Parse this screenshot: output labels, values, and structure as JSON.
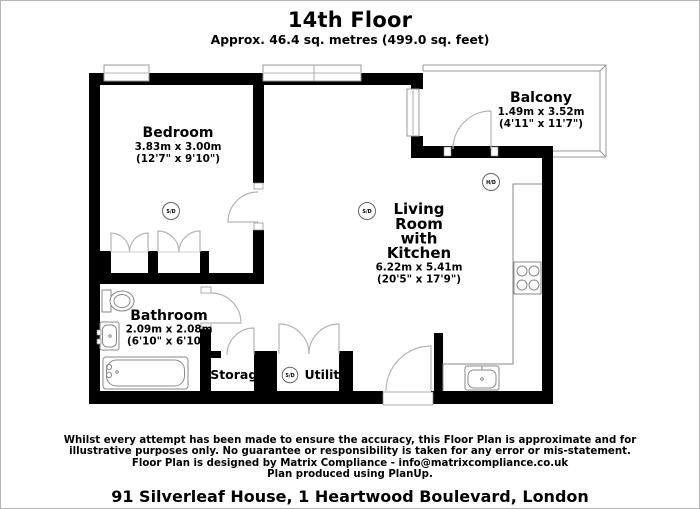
{
  "page": {
    "title": "14th Floor",
    "subtitle": "Approx. 46.4 sq. metres (499.0 sq. feet)"
  },
  "rooms": {
    "bedroom": {
      "name": "Bedroom",
      "metric": "3.83m x 3.00m",
      "imperial": "(12'7\" x 9'10\")"
    },
    "balcony": {
      "name": "Balcony",
      "metric": "1.49m x 3.52m",
      "imperial": "(4'11\" x 11'7\")"
    },
    "living": {
      "name_lines": [
        "Living",
        "Room",
        "with",
        "Kitchen"
      ],
      "metric": "6.22m x 5.41m",
      "imperial": "(20'5\" x 17'9\")"
    },
    "bathroom": {
      "name": "Bathroom",
      "metric": "2.09m x 2.08m",
      "imperial": "(6'10\" x 6'10\")"
    },
    "storage": {
      "name": "Storage"
    },
    "utility": {
      "name": "Utility"
    }
  },
  "detectors": {
    "smoke_label": "S/D",
    "heat_label": "H/D"
  },
  "footer": {
    "disclaimer_lines": [
      "Whilst every attempt has been made to ensure the accuracy, this Floor Plan is approximate and for",
      "illustrative purposes only. No guarantee or responsibility is taken for any error or mis-statement.",
      "Floor Plan is designed by Matrix Compliance - info@matrixcompliance.co.uk",
      "Plan produced using PlanUp."
    ],
    "address": "91 Silverleaf House, 1 Heartwood Boulevard, London"
  },
  "colors": {
    "wall": "#000000",
    "door_arc": "#b4b4b4",
    "fixture_line": "#8a8a8a",
    "text": "#000000",
    "page_border": "#b5b5b5"
  }
}
